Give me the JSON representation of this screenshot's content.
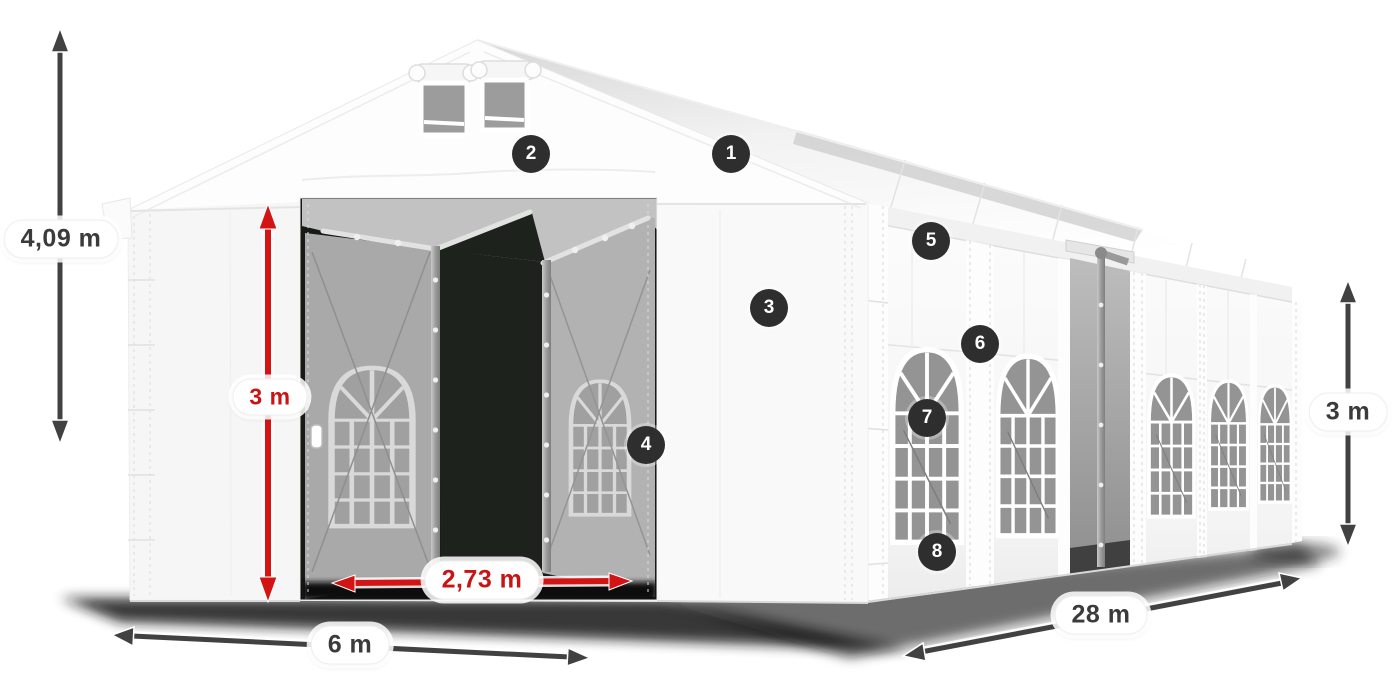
{
  "dimensions": {
    "total_height": "4,09 m",
    "entrance_height": "3 m",
    "entrance_width": "2,73 m",
    "front_width": "6 m",
    "length": "28 m",
    "side_height": "3 m"
  },
  "callouts": [
    {
      "number": "1"
    },
    {
      "number": "2"
    },
    {
      "number": "3"
    },
    {
      "number": "4"
    },
    {
      "number": "5"
    },
    {
      "number": "6"
    },
    {
      "number": "7"
    },
    {
      "number": "8"
    }
  ],
  "colors": {
    "arrow_dark": "#414141",
    "arrow_red": "#d31414",
    "label_text_dark": "#3b3b3b",
    "label_text_red": "#c81414",
    "badge_background": "#2e2e2e",
    "badge_text": "#ffffff",
    "tent_white": "#fdfdfd",
    "interior_gray": "#a9a9a9",
    "background": "#ffffff"
  }
}
